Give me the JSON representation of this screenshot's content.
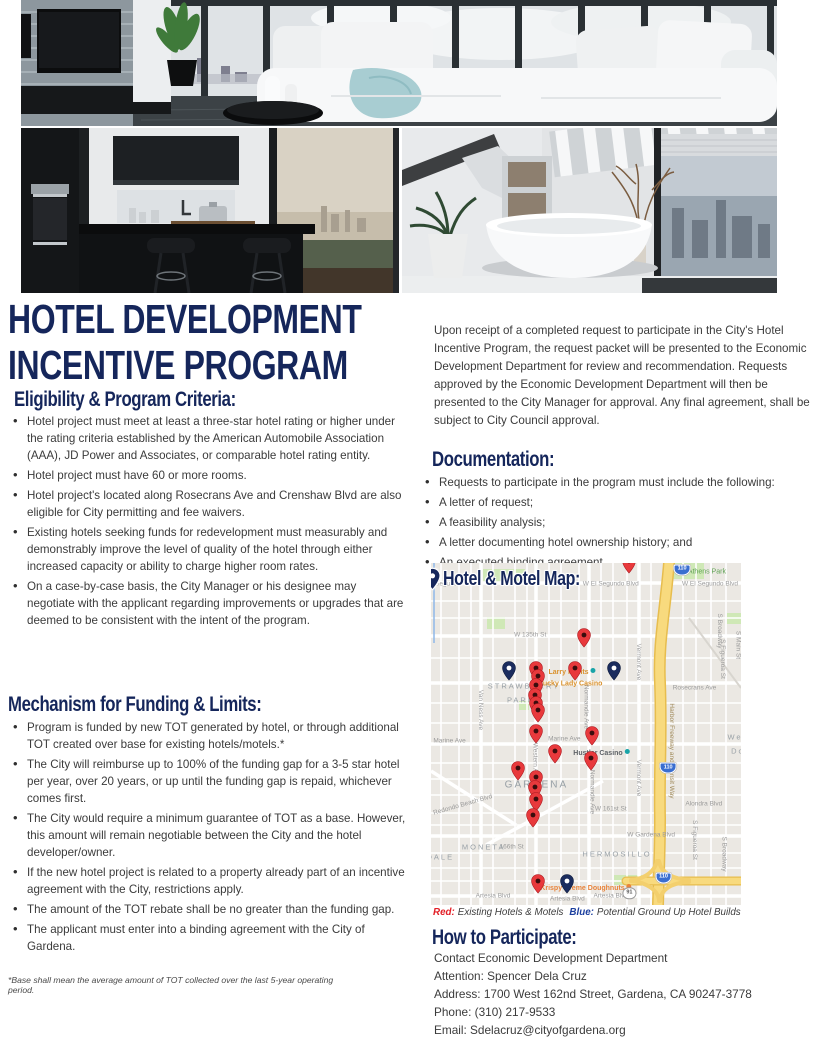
{
  "title": {
    "line1": "HOTEL DEVELOPMENT",
    "line2": "INCENTIVE PROGRAM"
  },
  "hero": {
    "photos": [
      "modern-living-room",
      "modern-kitchen",
      "modern-bathroom"
    ]
  },
  "eligibility": {
    "heading": "Eligibility & Program Criteria:",
    "items": [
      "Hotel project must meet at least a three-star hotel rating or higher under the rating criteria established by the American Automobile Association (AAA), JD Power and Associates, or comparable hotel rating entity.",
      "Hotel project must have 60 or more rooms.",
      "Hotel project's located along Rosecrans Ave and Crenshaw Blvd are also eligible for City permitting and fee waivers.",
      "Existing hotels seeking funds for redevelopment must measurably and demonstrably improve the level of quality of the hotel through either increased capacity or ability to charge higher room rates.",
      "On a case-by-case basis, the City Manager or his designee may negotiate with the applicant regarding improvements or upgrades that are deemed to be consistent with the intent of the program."
    ]
  },
  "mechanism": {
    "heading": "Mechanism for Funding & Limits:",
    "items": [
      "Program is funded by new TOT generated by hotel, or through additional TOT created over base for existing hotels/motels.*",
      "The City will reimburse up to 100% of the funding gap for a 3-5 star hotel per year, over 20 years, or up until the funding gap is repaid, whichever comes first.",
      "The City would require a minimum guarantee of TOT as a base. However, this amount will remain negotiable between the City and the hotel developer/owner.",
      "If the new hotel project is related to a property already part of an incentive agreement with the City, restrictions apply.",
      "The amount of the TOT rebate shall be no greater than the funding gap.",
      "The applicant must enter into a binding agreement with the City of Gardena."
    ]
  },
  "footnote": "*Base shall mean the average amount of TOT collected over the last 5-year operating period.",
  "intro": "Upon receipt of a completed request to participate in the City's Hotel Incentive Program, the request packet will be presented to the Economic Development Department for review and recommendation. Requests approved by the Economic Development Department will then be presented to the City Manager for approval. Any final agreement, shall be subject to City Council approval.",
  "documentation": {
    "heading": "Documentation:",
    "items": [
      "Requests to participate in the program must include the following:",
      "A letter of request;",
      "A feasibility analysis;",
      "A letter documenting hotel ownership history; and",
      "An executed binding agreement."
    ]
  },
  "map": {
    "heading": "Hotel & Motel Map:",
    "legend": {
      "red_label": "Red:",
      "red_text": "Existing Hotels & Motels",
      "blue_label": "Blue:",
      "blue_text": "Potential Ground Up Hotel Builds"
    },
    "colors": {
      "red_pin": "#e8393c",
      "blue_pin": "#1b2c5e",
      "navy_heading": "#15265b"
    },
    "pins": [
      {
        "x": 64,
        "y": 2.3,
        "c": "red"
      },
      {
        "x": 49.5,
        "y": 24,
        "c": "red"
      },
      {
        "x": 46.5,
        "y": 33.5,
        "c": "red"
      },
      {
        "x": 34,
        "y": 33.5,
        "c": "red"
      },
      {
        "x": 34.5,
        "y": 36,
        "c": "red"
      },
      {
        "x": 34,
        "y": 38.5,
        "c": "red"
      },
      {
        "x": 33.5,
        "y": 41.5,
        "c": "red"
      },
      {
        "x": 34,
        "y": 44,
        "c": "red"
      },
      {
        "x": 34.5,
        "y": 45.8,
        "c": "red"
      },
      {
        "x": 34,
        "y": 52,
        "c": "red"
      },
      {
        "x": 52,
        "y": 52.5,
        "c": "red"
      },
      {
        "x": 40,
        "y": 58,
        "c": "red"
      },
      {
        "x": 51.5,
        "y": 60,
        "c": "red"
      },
      {
        "x": 28,
        "y": 63,
        "c": "red"
      },
      {
        "x": 34,
        "y": 65.5,
        "c": "red"
      },
      {
        "x": 33.5,
        "y": 68.5,
        "c": "red"
      },
      {
        "x": 34,
        "y": 72,
        "c": "red"
      },
      {
        "x": 33,
        "y": 76.5,
        "c": "red"
      },
      {
        "x": 34.5,
        "y": 95.8,
        "c": "red"
      },
      {
        "x": 25,
        "y": 33.5,
        "c": "blue"
      },
      {
        "x": 59,
        "y": 33.5,
        "c": "blue"
      },
      {
        "x": 44,
        "y": 95.8,
        "c": "blue"
      }
    ],
    "labels": [
      {
        "text": "W El Segundo",
        "x": 3,
        "y": 6,
        "kind": "street"
      },
      {
        "text": "W El Segundo Blvd",
        "x": 58,
        "y": 6,
        "kind": "street"
      },
      {
        "text": "W El Segundo Blvd",
        "x": 90,
        "y": 6,
        "kind": "street"
      },
      {
        "text": "W 135th St",
        "x": 32,
        "y": 21,
        "kind": "street"
      },
      {
        "text": "Rosecrans Ave",
        "x": 85,
        "y": 36.5,
        "kind": "street"
      },
      {
        "text": "Marine Ave",
        "x": 6,
        "y": 52,
        "kind": "street"
      },
      {
        "text": "Marine Ave",
        "x": 43,
        "y": 51.5,
        "kind": "street"
      },
      {
        "text": "W 161st St",
        "x": 58,
        "y": 72,
        "kind": "street"
      },
      {
        "text": "W Gardena Blvd",
        "x": 71,
        "y": 79.5,
        "kind": "street"
      },
      {
        "text": "Alondra Blvd",
        "x": 88,
        "y": 70.5,
        "kind": "street"
      },
      {
        "text": "Artesia Blvd",
        "x": 20,
        "y": 97.5,
        "kind": "street"
      },
      {
        "text": "Artesia Blvd",
        "x": 44,
        "y": 98.2,
        "kind": "street"
      },
      {
        "text": "Artesia Blvd",
        "x": 58,
        "y": 97.5,
        "kind": "street"
      },
      {
        "text": "W Redondo Beach Blvd",
        "x": 9,
        "y": 71,
        "kind": "street",
        "rot": -16
      },
      {
        "text": "166th St",
        "x": 26,
        "y": 83,
        "kind": "street"
      },
      {
        "text": "Van Ness Ave",
        "x": 16,
        "y": 43,
        "kind": "street-v"
      },
      {
        "text": "S Western Ave",
        "x": 33.5,
        "y": 57,
        "kind": "street-v"
      },
      {
        "text": "Normandie Ave",
        "x": 50,
        "y": 42,
        "kind": "street-v"
      },
      {
        "text": "Normandie Ave",
        "x": 52,
        "y": 67,
        "kind": "street-v"
      },
      {
        "text": "Vermont Ave",
        "x": 67,
        "y": 29,
        "kind": "street-v"
      },
      {
        "text": "Vermont Ave",
        "x": 67,
        "y": 63,
        "kind": "street-v"
      },
      {
        "text": "S Broadway",
        "x": 93,
        "y": 20,
        "kind": "street-v"
      },
      {
        "text": "S Broadway",
        "x": 94.5,
        "y": 85,
        "kind": "street-v"
      },
      {
        "text": "S Figueroa St",
        "x": 94,
        "y": 28,
        "kind": "street-v"
      },
      {
        "text": "S Figueroa St",
        "x": 85,
        "y": 81,
        "kind": "street-v"
      },
      {
        "text": "S Main St",
        "x": 99,
        "y": 24,
        "kind": "street-v"
      },
      {
        "text": "Harbor Freeway and Transit Way",
        "x": 77.5,
        "y": 55,
        "kind": "street-v",
        "color": "#a08a5a"
      },
      {
        "text": "STRAWBERRY",
        "x": 30,
        "y": 36,
        "kind": "area"
      },
      {
        "text": "PARK",
        "x": 29,
        "y": 40,
        "kind": "area"
      },
      {
        "text": "GARDENA",
        "x": 34,
        "y": 65,
        "kind": "area",
        "size": 10
      },
      {
        "text": "MONETA",
        "x": 17,
        "y": 83,
        "kind": "area"
      },
      {
        "text": "HERMOSILLO",
        "x": 60,
        "y": 85,
        "kind": "area"
      },
      {
        "text": "DALE",
        "x": 3,
        "y": 86,
        "kind": "area"
      },
      {
        "text": "Wes",
        "x": 99,
        "y": 51,
        "kind": "area"
      },
      {
        "text": "Do",
        "x": 99,
        "y": 55,
        "kind": "area"
      },
      {
        "text": "Athens Park",
        "x": 89,
        "y": 2.5,
        "kind": "park"
      },
      {
        "text": "Larry Flynts",
        "x": 45.5,
        "y": 32,
        "kind": "poi",
        "color": "#d9912c",
        "dot": "#19a4a8"
      },
      {
        "text": "Lucky Lady Casino",
        "x": 45,
        "y": 35.5,
        "kind": "poi",
        "color": "#d9912c"
      },
      {
        "text": "Hustler Casino",
        "x": 55,
        "y": 55.5,
        "kind": "poi",
        "color": "#5f6368",
        "dot": "#19a4a8"
      },
      {
        "text": "Krispy Kreme Doughnuts",
        "x": 50,
        "y": 95,
        "kind": "poi",
        "color": "#e8843c",
        "dot": "#e8843c"
      }
    ],
    "shields": [
      {
        "text": "110",
        "x": 81,
        "y": 2,
        "type": "interstate"
      },
      {
        "text": "110",
        "x": 76.5,
        "y": 60,
        "type": "interstate"
      },
      {
        "text": "110",
        "x": 75,
        "y": 92,
        "type": "interstate"
      },
      {
        "text": "91",
        "x": 64,
        "y": 96.5,
        "type": "state"
      }
    ]
  },
  "participate": {
    "heading": "How to Participate:",
    "lines": [
      "Contact Economic Development Department",
      "Attention: Spencer Dela Cruz",
      "Address: 1700 West 162nd Street, Gardena, CA 90247-3778",
      "Phone: (310) 217-9533",
      "Email: Sdelacruz@cityofgardena.org"
    ]
  }
}
